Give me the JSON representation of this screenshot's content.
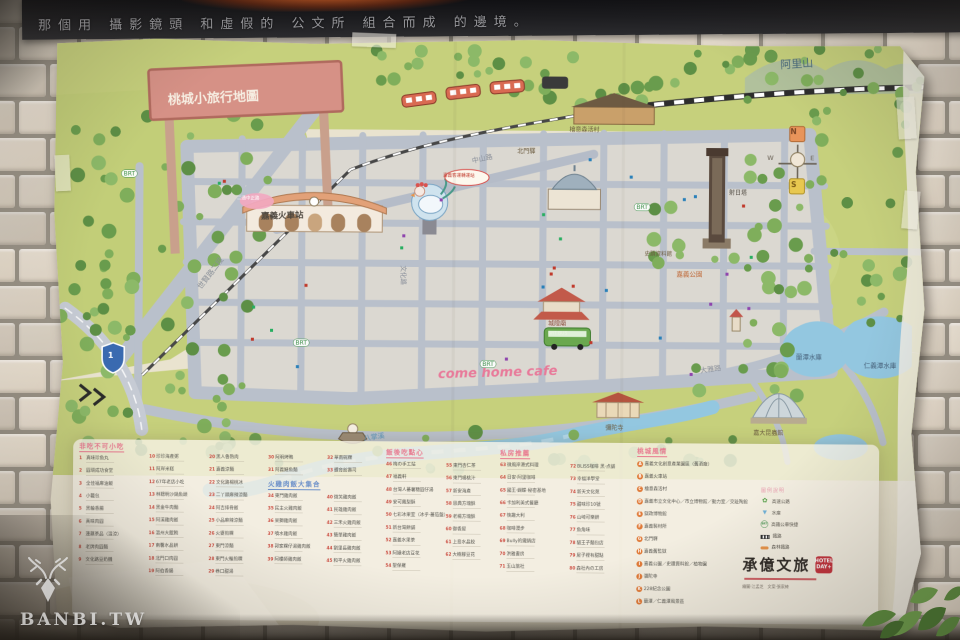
{
  "banner": {
    "text": "那個用 攝影鏡頭 和虛假的 公文所 組合而成 的邊境。"
  },
  "watermark": {
    "site": "BANBI.TW",
    "logo": "deer-logo"
  },
  "poster": {
    "title": "桃城小旅行地圖"
  },
  "brand": {
    "logo": "承億文旅",
    "badge": "HOTEL DAY+",
    "credits": "繪圖·江孟芝　文案·張家綺"
  },
  "map_key": {
    "header": "圖例說明",
    "items": [
      {
        "icon": "interchange",
        "label": "高速公路"
      },
      {
        "icon": "reservoir",
        "label": "水庫"
      },
      {
        "icon": "brt",
        "label": "高鐵公車快捷"
      },
      {
        "icon": "rail",
        "label": "鐵路"
      },
      {
        "icon": "forest-rail",
        "label": "森林鐵路"
      }
    ]
  },
  "map": {
    "labels": [
      {
        "t": "桃城小旅行地圖",
        "x": 116,
        "y": 58,
        "s": 13,
        "c": "#f7f0e4",
        "r": -3,
        "b": 1,
        "n": "map-title-sign"
      },
      {
        "t": "阿里山",
        "x": 728,
        "y": 20,
        "s": 11,
        "c": "#4a6b7c",
        "r": -4,
        "n": "alishan-label"
      },
      {
        "t": "嘉義火車站",
        "x": 210,
        "y": 176,
        "s": 8.5,
        "c": "#4a443c",
        "r": -2,
        "b": 1,
        "n": "train-station-label"
      },
      {
        "t": "come home cafe",
        "x": 388,
        "y": 330,
        "s": 13,
        "c": "#e87a9a",
        "i": 1,
        "r": -2,
        "b": 1,
        "n": "cafe-label"
      },
      {
        "t": "蘭潭水庫",
        "x": 746,
        "y": 314,
        "s": 6.5,
        "c": "#47617a",
        "n": "lantan-label"
      },
      {
        "t": "仁義潭水庫",
        "x": 814,
        "y": 322,
        "s": 6.5,
        "c": "#47617a",
        "n": "renyitan-label"
      },
      {
        "t": "嘉大昆蟲館",
        "x": 704,
        "y": 390,
        "s": 6,
        "c": "#6b5b3f",
        "n": "insect-museum-label"
      },
      {
        "t": "彌陀寺",
        "x": 556,
        "y": 386,
        "s": 6,
        "c": "#6b5b3f",
        "n": "mituo-temple-label"
      },
      {
        "t": "射日塔",
        "x": 678,
        "y": 150,
        "s": 6,
        "c": "#504a42",
        "n": "sun-shooting-tower-label"
      },
      {
        "t": "嘉義公園",
        "x": 626,
        "y": 232,
        "s": 6.5,
        "c": "#c06a3a",
        "n": "chiayi-park-label"
      },
      {
        "t": "史蹟資料館",
        "x": 594,
        "y": 212,
        "s": 5.5,
        "c": "#6b5b3f",
        "n": "historical-hall-label"
      },
      {
        "t": "中山路",
        "x": 420,
        "y": 120,
        "s": 7,
        "c": "#898f9a",
        "r": -13,
        "n": "zhongshan-road-label"
      },
      {
        "t": "文化路",
        "x": 356,
        "y": 228,
        "s": 6.5,
        "c": "#898f9a",
        "r": 90,
        "n": "wenhua-road-label"
      },
      {
        "t": "世賢路二段",
        "x": 146,
        "y": 250,
        "s": 7.5,
        "c": "#8a9099",
        "r": -53,
        "n": "shixian-road-label"
      },
      {
        "t": "大雅路",
        "x": 650,
        "y": 328,
        "s": 7,
        "c": "#898f9a",
        "r": -8,
        "n": "daya-road-label"
      },
      {
        "t": "八掌溪",
        "x": 314,
        "y": 398,
        "s": 7,
        "c": "#5a8fb0",
        "r": -8,
        "n": "bazhang-river-label"
      },
      {
        "t": "檜意森活村",
        "x": 518,
        "y": 88,
        "s": 6,
        "c": "#6b5b3f",
        "n": "hinoki-village-label"
      },
      {
        "t": "北門驛",
        "x": 466,
        "y": 110,
        "s": 6,
        "c": "#6b5b3f",
        "n": "beimen-station-label"
      },
      {
        "t": "城隍廟",
        "x": 498,
        "y": 282,
        "s": 6,
        "c": "#8a4a3a",
        "n": "city-god-temple-label"
      },
      {
        "t": "BRT",
        "x": 70,
        "y": 134,
        "s": 6,
        "c": "#3f8f4a",
        "badge": 1,
        "n": "brt-stop-label"
      },
      {
        "t": "BRT",
        "x": 243,
        "y": 302,
        "s": 6,
        "c": "#3f8f4a",
        "badge": 1,
        "n": "brt-stop-label"
      },
      {
        "t": "BRT",
        "x": 430,
        "y": 322,
        "s": 6,
        "c": "#3f8f4a",
        "badge": 1,
        "n": "brt-stop-label"
      },
      {
        "t": "BRT",
        "x": 583,
        "y": 164,
        "s": 6,
        "c": "#3f8f4a",
        "badge": 1,
        "n": "brt-stop-label"
      },
      {
        "t": "BRT BUS",
        "x": 498,
        "y": 293,
        "s": 4.5,
        "c": "#eaf5e2",
        "n": "brt-bus-label"
      },
      {
        "t": "N",
        "x": 739,
        "y": 88,
        "s": 7.5,
        "c": "#7a4626",
        "b": 1,
        "n": "compass-n"
      },
      {
        "t": "W",
        "x": 716,
        "y": 115,
        "s": 6.5,
        "c": "#6a6256",
        "n": "compass-w"
      },
      {
        "t": "E",
        "x": 759,
        "y": 115,
        "s": 6.5,
        "c": "#6a6256",
        "n": "compass-e"
      },
      {
        "t": "S",
        "x": 740,
        "y": 141,
        "s": 7.5,
        "c": "#7a5a16",
        "b": 1,
        "n": "compass-s"
      },
      {
        "t": "1",
        "x": 58,
        "y": 316,
        "s": 8,
        "c": "#ffffff",
        "b": 1,
        "n": "highway-1-shield-label"
      },
      {
        "t": "二通中正路",
        "x": 186,
        "y": 160,
        "s": 4.5,
        "c": "#ffffff",
        "n": "zhongzheng-road-tag"
      },
      {
        "t": "嘉義客運轉運站",
        "x": 392,
        "y": 136,
        "s": 4.5,
        "c": "#c0392b",
        "n": "bus-terminal-tag"
      }
    ]
  },
  "legend": {
    "columns": [
      {
        "x": 30,
        "y": 408,
        "entries": [
          {
            "h": "非吃不可小吃",
            "c": "#e8798f"
          },
          {
            "n": "1",
            "t": "真味珍魚丸"
          },
          {
            "n": "2",
            "t": "圓環成功食堂"
          },
          {
            "n": "3",
            "t": "全佳福麻油飯"
          },
          {
            "n": "4",
            "t": "小籠包"
          },
          {
            "n": "5",
            "t": "黑輪香腸"
          },
          {
            "n": "6",
            "t": "真味肉圓"
          },
          {
            "n": "7",
            "t": "蓮藕茶品（溫涼）"
          },
          {
            "n": "8",
            "t": "老牌肉圓麵"
          },
          {
            "n": "9",
            "t": "文化路豆奶攤"
          }
        ]
      },
      {
        "x": 100,
        "y": 419,
        "entries": [
          {
            "n": "10",
            "t": "珍珍海產粥"
          },
          {
            "n": "11",
            "t": "阿岸米糕"
          },
          {
            "n": "12",
            "t": "67年老店小吃"
          },
          {
            "n": "13",
            "t": "林聰明沙鍋魚頭"
          },
          {
            "n": "14",
            "t": "黑金牛肉麵"
          },
          {
            "n": "15",
            "t": "阿溪雞肉飯"
          },
          {
            "n": "16",
            "t": "溫州大餛飩"
          },
          {
            "n": "17",
            "t": "南馨水晶餅"
          },
          {
            "n": "18",
            "t": "北門口肉圓"
          },
          {
            "n": "19",
            "t": "阿伯香腸"
          }
        ]
      },
      {
        "x": 160,
        "y": 419,
        "entries": [
          {
            "n": "20",
            "t": "黑人魯熟肉"
          },
          {
            "n": "21",
            "t": "嘉義涼麵"
          },
          {
            "n": "22",
            "t": "文化路楊桃冰"
          },
          {
            "n": "23",
            "t": "二丫頭麻辣涼麵"
          },
          {
            "n": "24",
            "t": "阿吉排骨飯"
          },
          {
            "n": "25",
            "t": "小品麻辣涼麵"
          },
          {
            "n": "26",
            "t": "火婆煎粿"
          },
          {
            "n": "27",
            "t": "東門涼麵"
          },
          {
            "n": "28",
            "t": "東門火輪煎粿"
          },
          {
            "n": "29",
            "t": "巷口甜湯"
          }
        ]
      },
      {
        "x": 219,
        "y": 419,
        "entries": [
          {
            "n": "30",
            "t": "阿明烤鴨"
          },
          {
            "n": "31",
            "t": "阿義鱔魚麵"
          },
          {
            "h": "火雞肉飯大集合",
            "c": "#6b8fc9"
          },
          {
            "n": "34",
            "t": "東門雞肉飯"
          },
          {
            "n": "35",
            "t": "民主火雞肉飯"
          },
          {
            "n": "36",
            "t": "呆獅雞肉飯"
          },
          {
            "n": "37",
            "t": "噴水雞肉飯"
          },
          {
            "n": "38",
            "t": "郭家粿仔湯雞肉飯"
          },
          {
            "n": "39",
            "t": "阿樓師雞肉飯"
          }
        ]
      },
      {
        "x": 278,
        "y": 419,
        "entries": [
          {
            "n": "32",
            "t": "華南碗粿"
          },
          {
            "n": "33",
            "t": "體育館壽司"
          },
          {
            "sp": 1
          },
          {
            "n": "40",
            "t": "微笑雞肉飯"
          },
          {
            "n": "41",
            "t": "民雄雞肉飯"
          },
          {
            "n": "42",
            "t": "三禾火雞肉飯"
          },
          {
            "n": "43",
            "t": "簡單雞肉飯"
          },
          {
            "n": "44",
            "t": "劉里長雞肉飯"
          },
          {
            "n": "45",
            "t": "和平火雞肉飯"
          }
        ]
      },
      {
        "x": 337,
        "y": 412,
        "entries": [
          {
            "h": "飯後吃點心",
            "c": "#e8798f"
          },
          {
            "n": "46",
            "t": "梅の手工站"
          },
          {
            "n": "47",
            "t": "福義軒"
          },
          {
            "n": "48",
            "t": "台灣人蕃薯糖圓仔湯"
          },
          {
            "n": "49",
            "t": "安可鳳梨酥"
          },
          {
            "n": "50",
            "t": "七彩冰果室（冰乎·蕃茄盤）"
          },
          {
            "n": "51",
            "t": "新台灣餅舖"
          },
          {
            "n": "52",
            "t": "嘉義水果茶"
          },
          {
            "n": "53",
            "t": "阿娥老店豆花"
          },
          {
            "n": "54",
            "t": "聖保羅"
          }
        ]
      },
      {
        "x": 397,
        "y": 426,
        "entries": [
          {
            "n": "55",
            "t": "東門杏仁茶"
          },
          {
            "n": "56",
            "t": "東門楊桃汁"
          },
          {
            "n": "57",
            "t": "新安海產"
          },
          {
            "n": "58",
            "t": "恩典方塊酥"
          },
          {
            "n": "59",
            "t": "老楊方塊酥"
          },
          {
            "n": "60",
            "t": "御香屋"
          },
          {
            "n": "61",
            "t": "上島水晶餃"
          },
          {
            "n": "62",
            "t": "大樹腳豆花"
          }
        ]
      },
      {
        "x": 451,
        "y": 412,
        "entries": [
          {
            "h": "私房推薦",
            "c": "#e8798f"
          },
          {
            "n": "63",
            "t": "微風岸港式料理"
          },
          {
            "n": "64",
            "t": "日安·阿里咖啡"
          },
          {
            "n": "65",
            "t": "國王·蝴蝶·秘密基地"
          },
          {
            "n": "66",
            "t": "卡加利美式餐廳"
          },
          {
            "n": "67",
            "t": "筷趣大利"
          },
          {
            "n": "68",
            "t": "咖啡漫步"
          },
          {
            "n": "69",
            "t": "Bully的鐵鍋店"
          },
          {
            "n": "70",
            "t": "洪雅書房"
          },
          {
            "n": "71",
            "t": "玉山旅社"
          }
        ]
      },
      {
        "x": 521,
        "y": 426,
        "entries": [
          {
            "n": "72",
            "t": "BLISS咖啡 黑·点舖"
          },
          {
            "n": "73",
            "t": "幸福洋學堂"
          },
          {
            "n": "74",
            "t": "新天文化苑"
          },
          {
            "n": "75",
            "t": "甜味珍10號"
          },
          {
            "n": "76",
            "t": "山崎可樂餅"
          },
          {
            "n": "77",
            "t": "魚角味"
          },
          {
            "n": "78",
            "t": "貓王子麵包店"
          },
          {
            "n": "79",
            "t": "屋子裡有甜點"
          },
          {
            "n": "80",
            "t": "森社內の工房"
          }
        ]
      },
      {
        "x": 588,
        "y": 409,
        "w": 225,
        "entries": [
          {
            "h": "桃城風情",
            "c": "#e8798f"
          },
          {
            "n": "A",
            "k": 1,
            "t": "嘉義文化創意產業園區（舊酒廠）"
          },
          {
            "n": "B",
            "k": 1,
            "t": "嘉義火車站"
          },
          {
            "n": "C",
            "k": 1,
            "t": "檜意森活村"
          },
          {
            "n": "D",
            "k": 1,
            "t": "嘉義市立文化中心／市立博物館／動力室／交趾陶館"
          },
          {
            "n": "E",
            "k": 1,
            "t": "獄政博物館"
          },
          {
            "n": "F",
            "k": 1,
            "t": "嘉義製材所"
          },
          {
            "n": "G",
            "k": 1,
            "t": "北門驛"
          },
          {
            "n": "H",
            "k": 1,
            "t": "嘉義舊監獄"
          },
          {
            "n": "I",
            "k": 1,
            "t": "嘉義公園／史蹟資料館／植物園"
          },
          {
            "n": "J",
            "k": 1,
            "t": "彌陀寺"
          },
          {
            "n": "K",
            "k": 1,
            "t": "228紀念公園"
          },
          {
            "n": "L",
            "k": 1,
            "t": "蘭潭／仁義潭風景區"
          }
        ]
      }
    ]
  }
}
